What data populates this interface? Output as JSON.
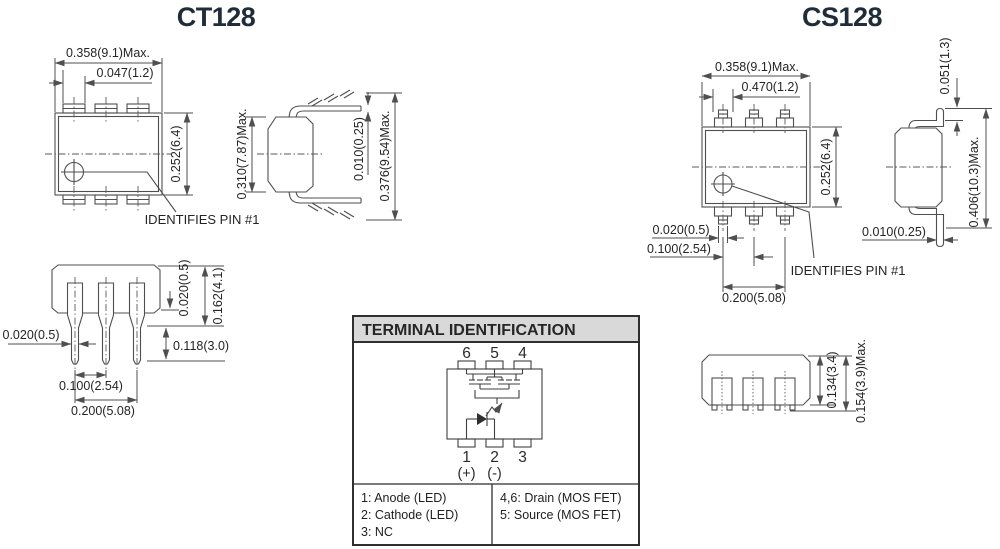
{
  "titles": {
    "left": "CT128",
    "right": "CS128"
  },
  "colors": {
    "title": "#202c3a",
    "line": "#4f4f4f",
    "text": "#242424",
    "panel_header_bg": "#d9d9d9",
    "panel_border": "#2f2f2f"
  },
  "ct128": {
    "top_view": {
      "dim_width": "0.358(9.1)Max.",
      "dim_pin": "0.047(1.2)",
      "dim_depth": "0.252(6.4)",
      "pin1_note": "IDENTIFIES PIN #1"
    },
    "side_view": {
      "dim_body": "0.310(7.87)Max.",
      "dim_lead": "0.010(0.25)",
      "dim_total": "0.376(9.54)Max."
    },
    "front_view": {
      "dim_standoff": "0.020(0.5)",
      "dim_shoulder_len": "0.162(4.1)",
      "dim_tip_len": "0.118(3.0)",
      "dim_lead_w": "0.020(0.5)",
      "dim_pitch": "0.100(2.54)",
      "dim_span": "0.200(5.08)"
    }
  },
  "cs128": {
    "top_view": {
      "dim_width": "0.358(9.1)Max.",
      "dim_pin": "0.470(1.2)",
      "dim_depth": "0.252(6.4)",
      "dim_lead_w": "0.020(0.5)",
      "dim_pitch": "0.100(2.54)",
      "dim_span": "0.200(5.08)",
      "pin1_note": "IDENTIFIES PIN #1"
    },
    "side_view": {
      "dim_foot": "0.051(1.3)",
      "dim_total": "0.406(10.3)Max.",
      "dim_lead": "0.010(0.25)"
    },
    "bottom_view": {
      "dim_body": "0.134(3.4)",
      "dim_total": "0.154(3.9)Max."
    }
  },
  "terminal": {
    "title": "TERMINAL IDENTIFICATION",
    "pins_top": [
      "6",
      "5",
      "4"
    ],
    "pins_bottom": [
      "1",
      "2",
      "3"
    ],
    "polarity_plus": "(+)",
    "polarity_minus": "(-)",
    "legend_left": [
      "1: Anode (LED)",
      "2: Cathode (LED)",
      "3: NC"
    ],
    "legend_right": [
      "4,6: Drain (MOS FET)",
      "5: Source (MOS FET)"
    ]
  }
}
